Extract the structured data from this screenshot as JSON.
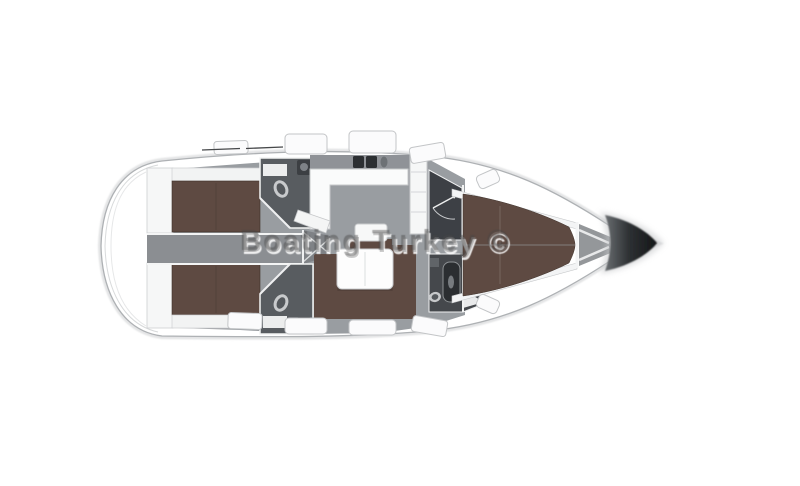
{
  "watermark": {
    "text": "Boating Turkey ©"
  },
  "diagram": {
    "type": "sailing-yacht-interior-layout",
    "view": "top-down",
    "bow_direction": "right",
    "rooms": [
      "swim-platform",
      "aft-cabin-port",
      "aft-cabin-starboard",
      "companionway-corridor",
      "head-port",
      "head-starboard",
      "galley",
      "saloon",
      "chart-seat",
      "saloon-table",
      "u-settee",
      "wardrobe",
      "forward-head",
      "forward-cabin",
      "anchor-locker",
      "bow"
    ]
  },
  "colors": {
    "background": "#ffffff",
    "hull_white": "#ffffff",
    "hull_outline_gray": "#aeb1b4",
    "interior_floor_gray": "#999da1",
    "corridor_gray": "#8b8e92",
    "bed_brown": "#5e4a42",
    "head_floor_dark": "#585c60",
    "wardrobe_dark": "#3d4045",
    "bow_tip_dark": "#1c1e20",
    "counter_white": "#fafbfb",
    "watermark_gray": "#828282"
  }
}
